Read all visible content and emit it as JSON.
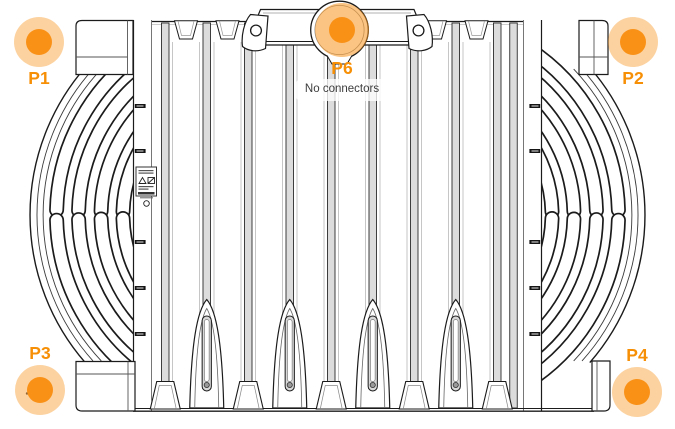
{
  "figure": {
    "name": "radio-unit-heatsink-rear-view",
    "type": "technical-line-drawing"
  },
  "markers": [
    {
      "id": "P1",
      "label": "P1",
      "position": "top-left"
    },
    {
      "id": "P2",
      "label": "P2",
      "position": "top-right"
    },
    {
      "id": "P3",
      "label": "P3",
      "position": "bottom-left"
    },
    {
      "id": "P4",
      "label": "P4",
      "position": "bottom-right"
    },
    {
      "id": "P6",
      "label": "P6",
      "position": "top-center",
      "tooltip": "No connectors"
    }
  ],
  "colors": {
    "marker-core": "#fa9117",
    "marker-halo": "rgba(247,148,29,0.42)",
    "marker-halo-strong": "rgba(247,148,29,0.55)",
    "marker-label": "#f78f06",
    "tooltip-text": "#3d3d3d",
    "tooltip-bg": "rgba(255,255,255,0.78)",
    "drawing-line": "#1b1b1b"
  }
}
